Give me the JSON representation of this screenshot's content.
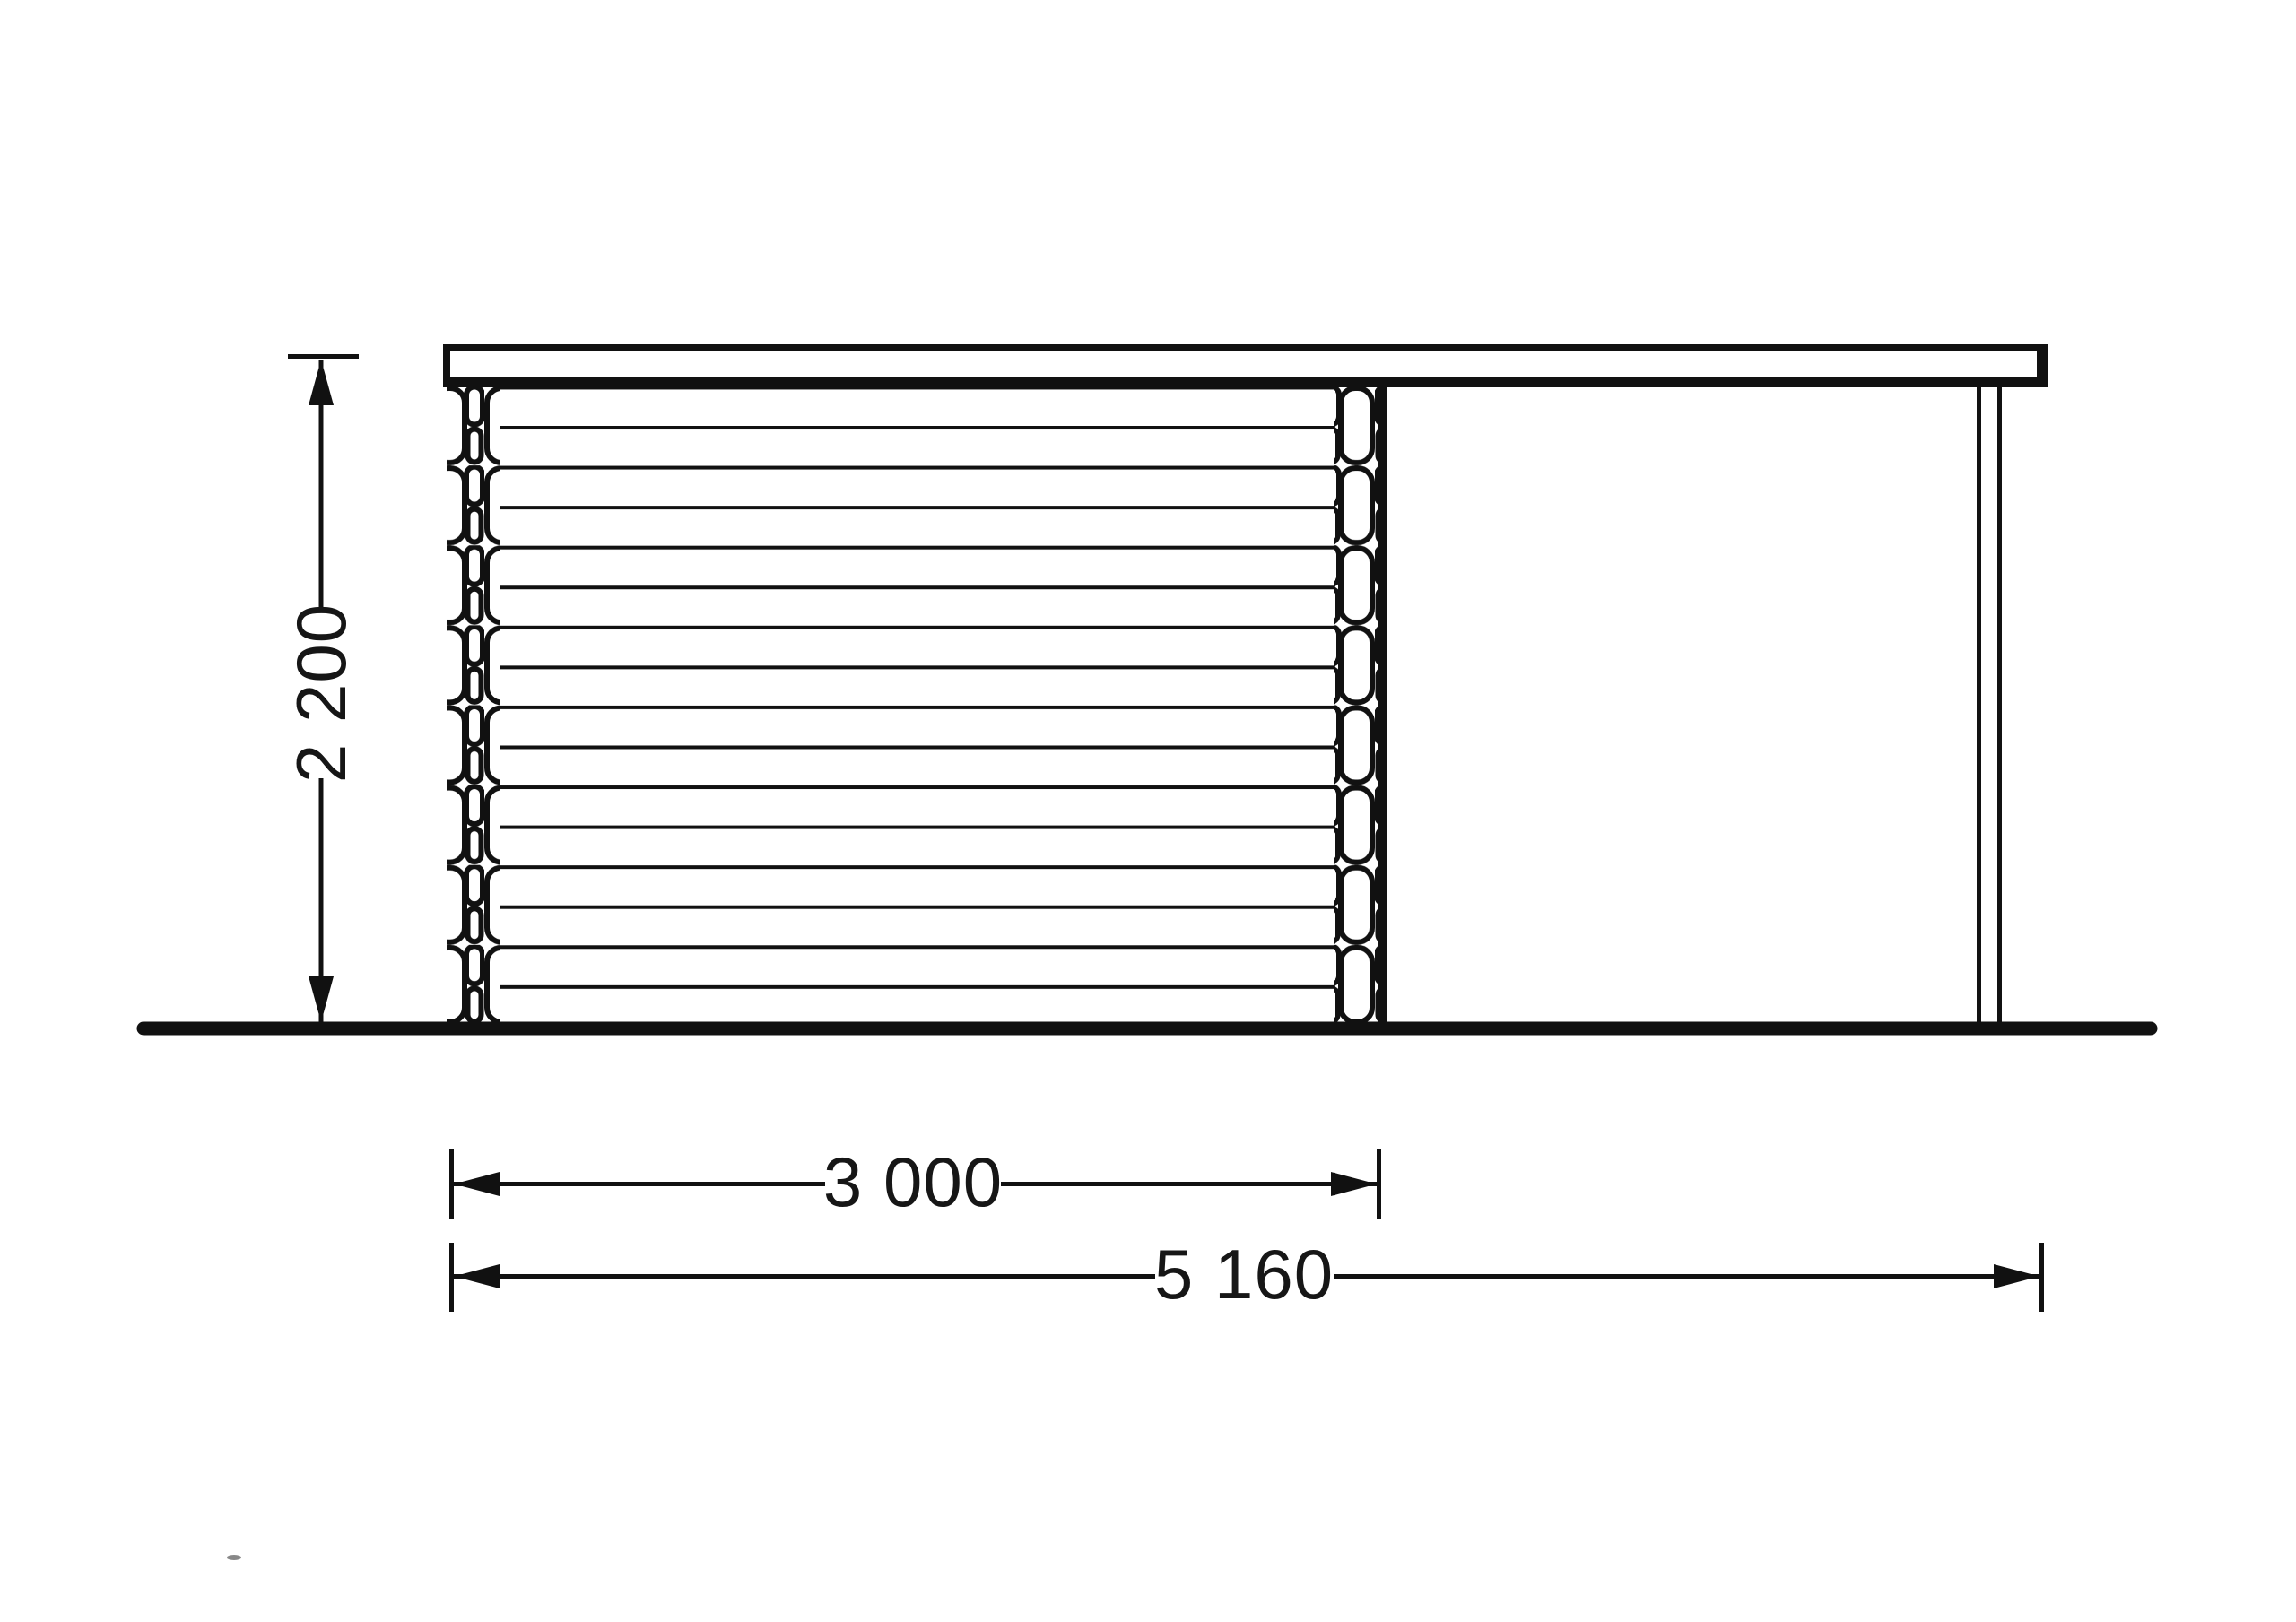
{
  "meta": {
    "type": "technical-elevation-drawing",
    "subject": "log cabin with carport side elevation",
    "units": "mm"
  },
  "colors": {
    "background": "#ffffff",
    "line": "#111111",
    "text": "#161616"
  },
  "dimensions": {
    "height": {
      "label": "2 200",
      "orientation": "vertical"
    },
    "cabin_width": {
      "label": "3 000",
      "orientation": "horizontal"
    },
    "total_width": {
      "label": "5 160",
      "orientation": "horizontal"
    }
  }
}
